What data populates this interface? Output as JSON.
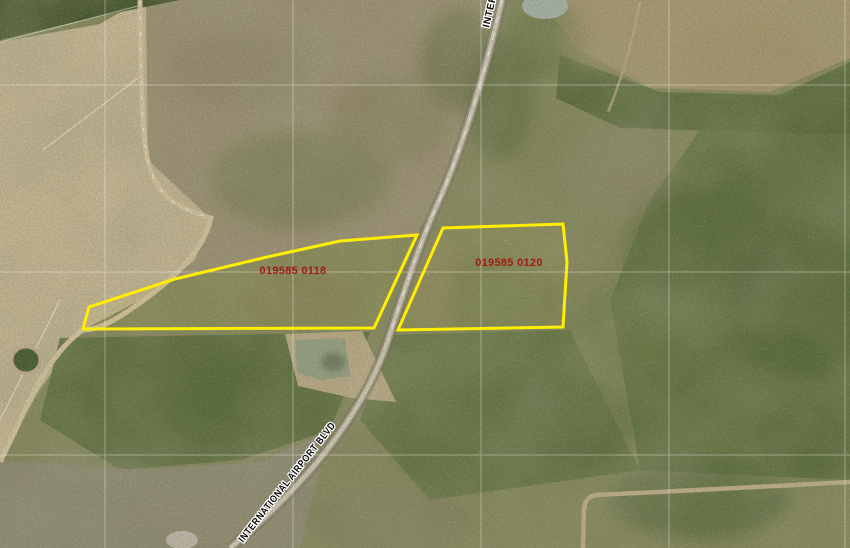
{
  "map": {
    "type": "aerial-parcel-map",
    "parcels": [
      {
        "id_label": "019585 0118"
      },
      {
        "id_label": "019585 0120"
      }
    ],
    "roads": {
      "main_label": "INTERNATIONAL AIRPORT BLVD",
      "main_label_top": "INTERNATIONAL AIRPORT BLVD"
    },
    "colors": {
      "parcel_outline": "#ffee00",
      "parcel_label": "#9e1c12",
      "road_label": "#0a0a0a",
      "road_label_halo": "#ffffff",
      "grid_line": "#ffffff"
    }
  }
}
